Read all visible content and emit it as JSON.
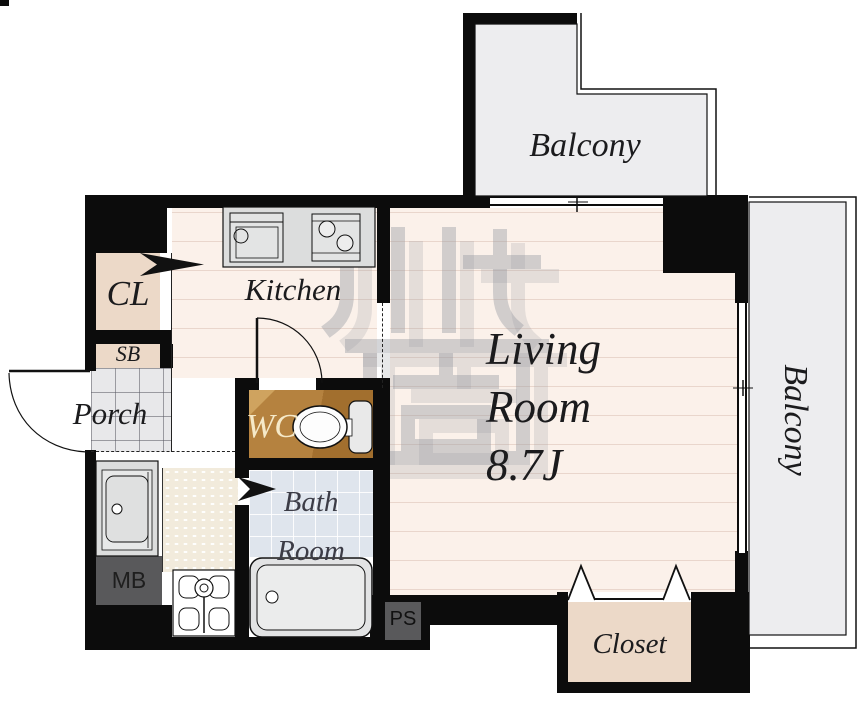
{
  "plan": {
    "rooms": {
      "balcony_top": {
        "label": "Balcony"
      },
      "balcony_right": {
        "label": "Balcony"
      },
      "living_room": {
        "line1": "Living",
        "line2": "Room",
        "size": "8.7J"
      },
      "kitchen": {
        "label": "Kitchen"
      },
      "closet_cl": {
        "label": "CL"
      },
      "shoe_box": {
        "label": "SB"
      },
      "porch": {
        "label": "Porch"
      },
      "wc": {
        "label": "WC"
      },
      "bath_room": {
        "line1": "Bath",
        "line2": "Room"
      },
      "meter_box": {
        "label": "MB"
      },
      "pipe_space": {
        "label": "PS"
      },
      "closet": {
        "label": "Closet"
      }
    },
    "colors": {
      "wall": "#0c0c0c",
      "floor_pink": "#fbf1ea",
      "floor_line": "#e9d6cc",
      "room_beige": "#ecd9c8",
      "balcony_gray": "#ededef",
      "porch_tile": "#e8e8ea",
      "hall_cream": "#f2ebdc",
      "bath_tile_blue": "#dfe5ed",
      "wc_brown": "#b5823f",
      "wc_brown_dark": "#a26f2e",
      "fixture_gray": "#dcdddd",
      "utility_gray": "#59595b",
      "label_dark": "#1b1b1d",
      "wc_label_cream": "#f5e9c8",
      "watermark_gray": "#9598a0"
    }
  }
}
